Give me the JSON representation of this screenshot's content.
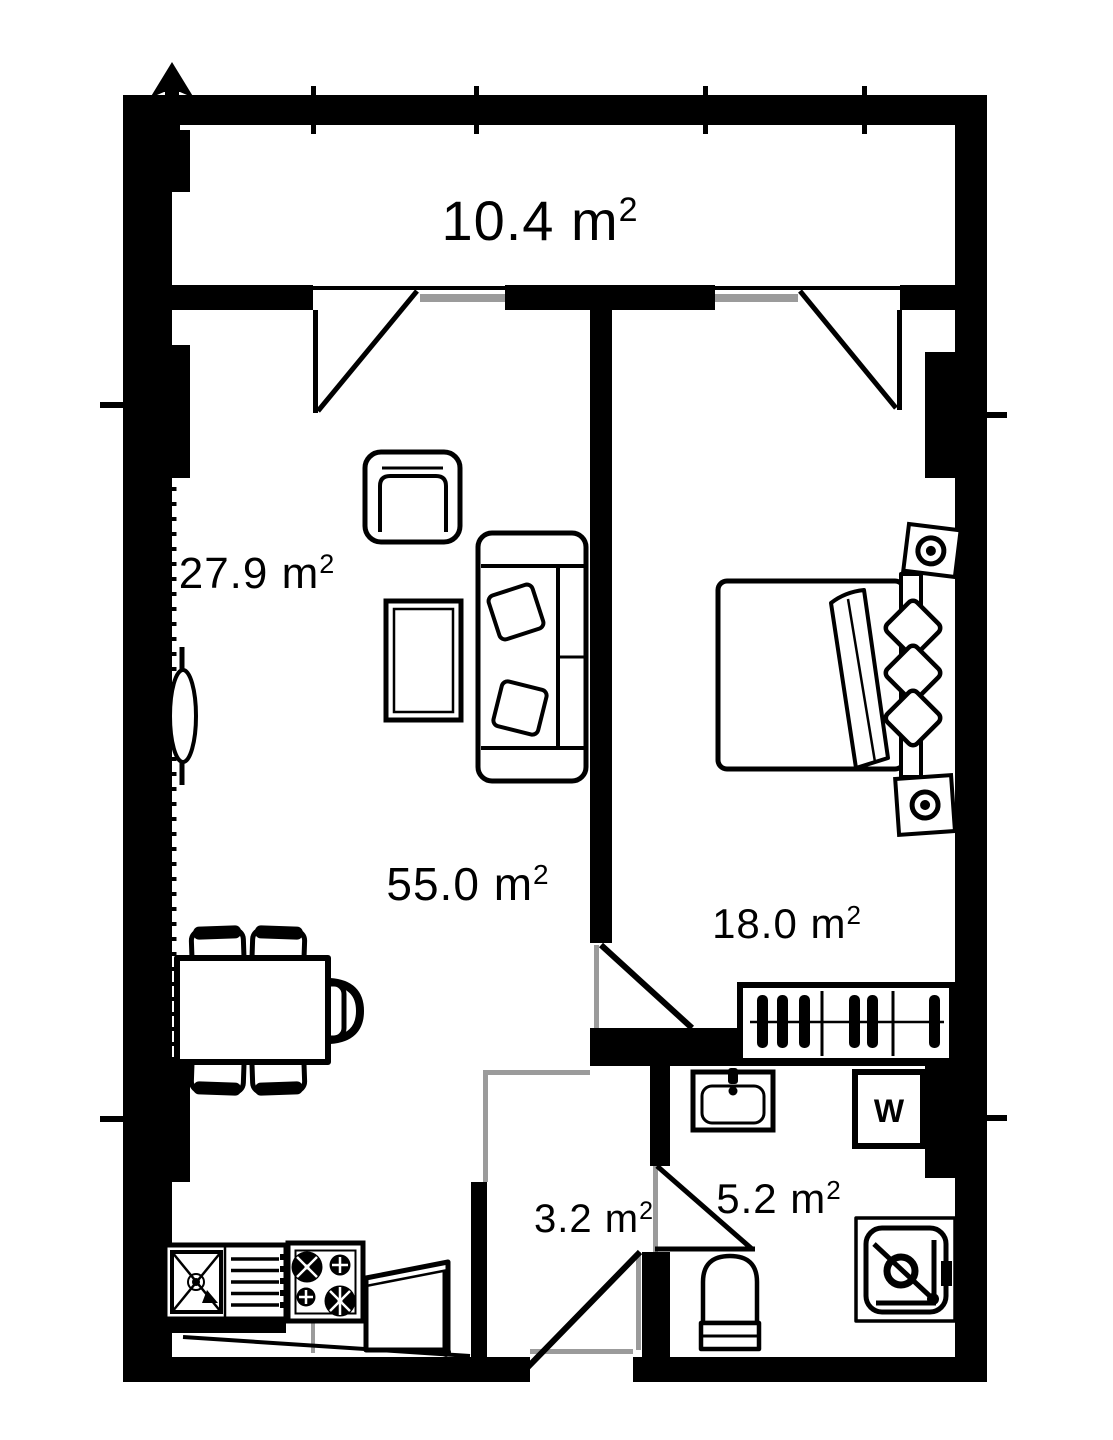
{
  "plan": {
    "type": "apartment-floor-plan",
    "rooms": {
      "balcony": {
        "area_value": "10.4 m",
        "area_sup": "2"
      },
      "living_room": {
        "area_value": "27.9 m",
        "area_sup": "2"
      },
      "total_area": {
        "area_value": "55.0 m",
        "area_sup": "2"
      },
      "bedroom": {
        "area_value": "18.0 m",
        "area_sup": "2"
      },
      "hallway": {
        "area_value": "3.2 m",
        "area_sup": "2"
      },
      "bathroom": {
        "area_value": "5.2 m",
        "area_sup": "2"
      }
    },
    "appliances": {
      "washing_machine_label": "W"
    },
    "colors": {
      "wall": "#000000",
      "background": "#ffffff",
      "opening_gray": "#9b9b9b"
    }
  }
}
